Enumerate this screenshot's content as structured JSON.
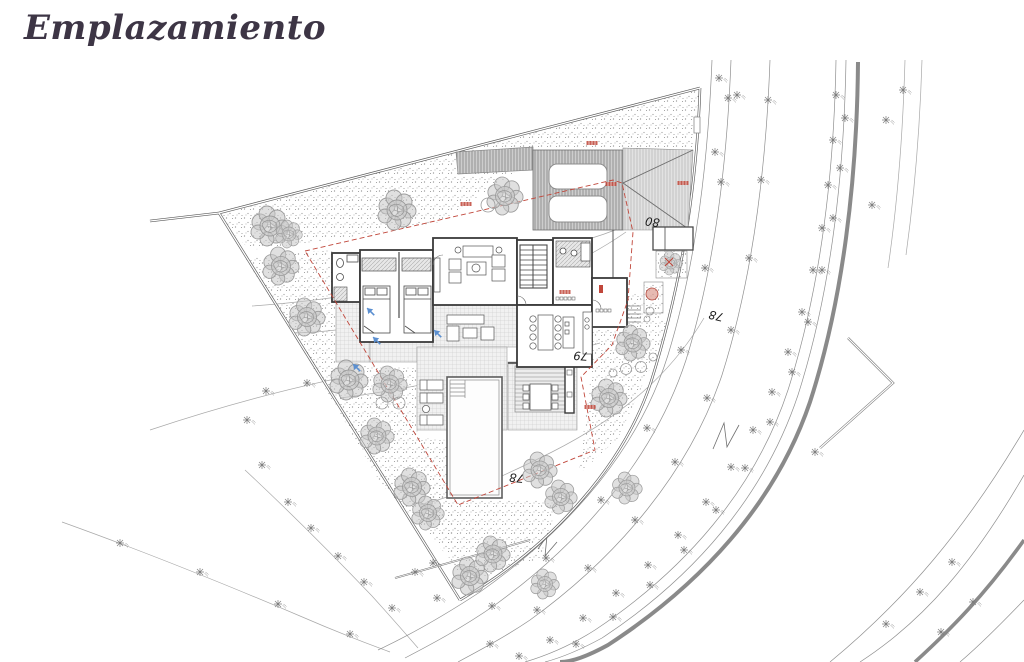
{
  "page": {
    "title": "Emplazamiento",
    "background": "#ffffff"
  },
  "drawing": {
    "type": "architectural-site-plan",
    "contour_labels": [
      {
        "text": "80",
        "x": 653,
        "y": 218,
        "rot": 188
      },
      {
        "text": "79",
        "x": 581,
        "y": 352,
        "rot": 184
      },
      {
        "text": "78",
        "x": 517,
        "y": 474,
        "rot": 186
      },
      {
        "text": "78",
        "x": 717,
        "y": 312,
        "rot": 193
      }
    ],
    "colors": {
      "setback_red": "#c0463a",
      "drain_blue": "#5b8fd0",
      "wall": "#3a3a3a",
      "road_thick": "#8a8a8a",
      "thin_line": "#9a9a9a",
      "tree_fill": "#c6c6c6",
      "tree_stroke": "#9b9b9b"
    },
    "trees": [
      [
        270,
        226,
        1.0
      ],
      [
        289,
        234,
        0.7
      ],
      [
        281,
        266,
        0.95
      ],
      [
        307,
        317,
        0.95
      ],
      [
        349,
        380,
        1.0
      ],
      [
        390,
        384,
        0.9
      ],
      [
        377,
        436,
        0.9
      ],
      [
        412,
        487,
        0.95
      ],
      [
        428,
        513,
        0.85
      ],
      [
        470,
        576,
        0.95
      ],
      [
        493,
        554,
        0.9
      ],
      [
        397,
        210,
        1.0
      ],
      [
        505,
        196,
        0.95
      ],
      [
        540,
        470,
        0.9
      ],
      [
        561,
        497,
        0.85
      ],
      [
        609,
        398,
        0.95
      ],
      [
        633,
        343,
        0.9
      ],
      [
        671,
        263,
        0.6
      ],
      [
        627,
        488,
        0.8
      ],
      [
        545,
        584,
        0.75
      ]
    ],
    "shrub_circles": [
      [
        488,
        205,
        7
      ],
      [
        382,
        403,
        6
      ],
      [
        399,
        403,
        6
      ],
      [
        626,
        369,
        5.5
      ],
      [
        641,
        367,
        5.5
      ],
      [
        613,
        373,
        4
      ],
      [
        650,
        311,
        4
      ],
      [
        647,
        319,
        3
      ],
      [
        653,
        357,
        4
      ]
    ],
    "survey_markers": [
      [
        836,
        95
      ],
      [
        833,
        140
      ],
      [
        828,
        185
      ],
      [
        822,
        228
      ],
      [
        813,
        270
      ],
      [
        802,
        312
      ],
      [
        788,
        352
      ],
      [
        772,
        392
      ],
      [
        753,
        430
      ],
      [
        731,
        467
      ],
      [
        706,
        502
      ],
      [
        678,
        535
      ],
      [
        648,
        565
      ],
      [
        616,
        593
      ],
      [
        583,
        618
      ],
      [
        550,
        640
      ],
      [
        519,
        656
      ],
      [
        845,
        118
      ],
      [
        840,
        168
      ],
      [
        833,
        218
      ],
      [
        822,
        270
      ],
      [
        808,
        322
      ],
      [
        792,
        372
      ],
      [
        770,
        422
      ],
      [
        745,
        468
      ],
      [
        716,
        510
      ],
      [
        684,
        550
      ],
      [
        650,
        585
      ],
      [
        613,
        617
      ],
      [
        576,
        644
      ],
      [
        768,
        100
      ],
      [
        761,
        180
      ],
      [
        749,
        258
      ],
      [
        731,
        330
      ],
      [
        707,
        398
      ],
      [
        675,
        462
      ],
      [
        635,
        520
      ],
      [
        588,
        568
      ],
      [
        537,
        610
      ],
      [
        490,
        644
      ],
      [
        728,
        98
      ],
      [
        721,
        182
      ],
      [
        705,
        268
      ],
      [
        681,
        350
      ],
      [
        647,
        428
      ],
      [
        601,
        500
      ],
      [
        546,
        558
      ],
      [
        492,
        606
      ],
      [
        886,
        120
      ],
      [
        903,
        90
      ],
      [
        872,
        205
      ],
      [
        815,
        452
      ],
      [
        952,
        562
      ],
      [
        920,
        592
      ],
      [
        886,
        624
      ],
      [
        973,
        602
      ],
      [
        941,
        632
      ],
      [
        719,
        78
      ],
      [
        715,
        152
      ],
      [
        737,
        95
      ],
      [
        266,
        391
      ],
      [
        307,
        383
      ],
      [
        247,
        420
      ],
      [
        262,
        465
      ],
      [
        288,
        502
      ],
      [
        311,
        528
      ],
      [
        338,
        556
      ],
      [
        364,
        582
      ],
      [
        392,
        608
      ],
      [
        433,
        563
      ],
      [
        437,
        598
      ],
      [
        120,
        543
      ],
      [
        200,
        572
      ],
      [
        278,
        604
      ],
      [
        350,
        634
      ],
      [
        415,
        572
      ]
    ],
    "red_marks": [
      [
        592,
        143
      ],
      [
        683,
        183
      ],
      [
        611,
        184
      ],
      [
        466,
        204
      ],
      [
        590,
        407
      ],
      [
        565,
        292
      ]
    ],
    "red_cross": [
      669,
      262
    ],
    "blue_arrows": [
      [
        370,
        311
      ],
      [
        376,
        340
      ],
      [
        356,
        367
      ],
      [
        437,
        333
      ]
    ]
  }
}
